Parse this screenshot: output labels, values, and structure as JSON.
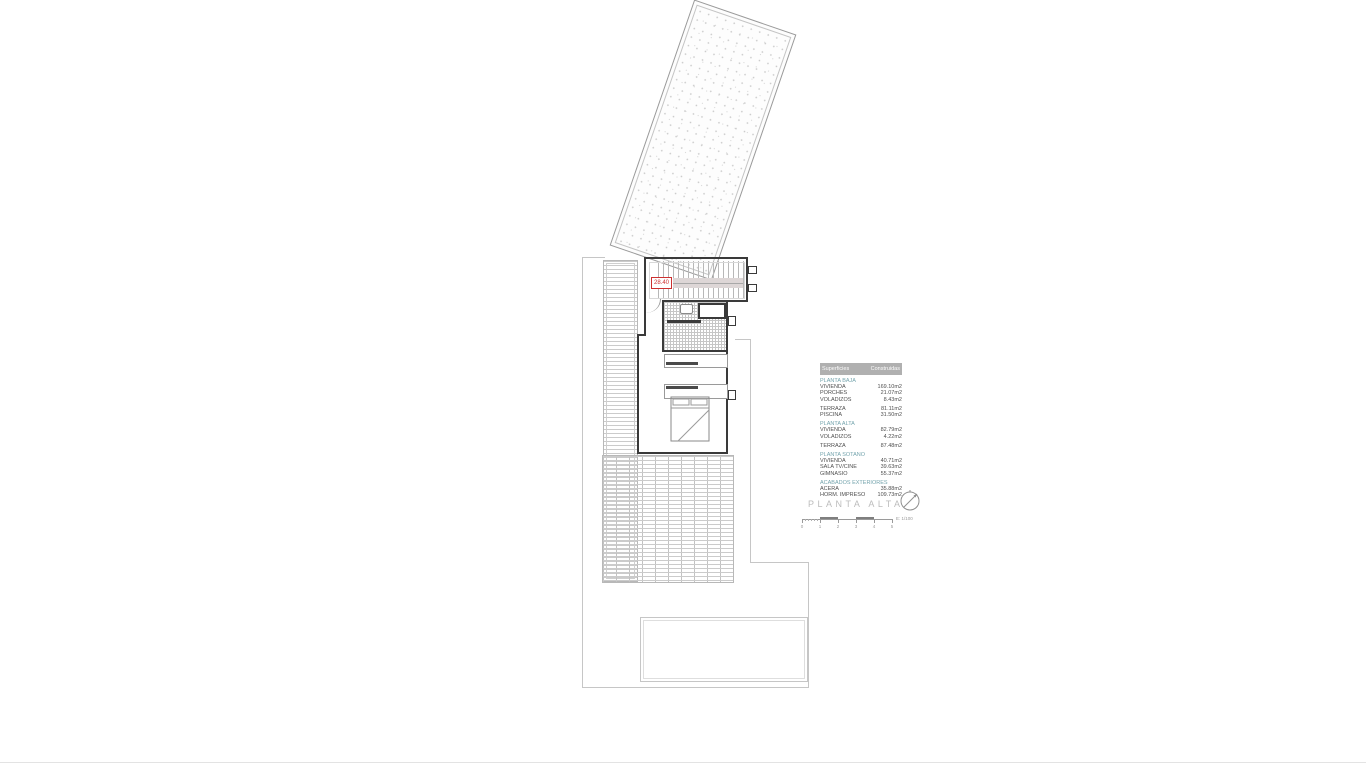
{
  "plan": {
    "title": "PLANTA ALTA",
    "level_label": "28.40",
    "scale_text": "E: 1/100",
    "scale_ticks": [
      "0",
      "1",
      "2",
      "3",
      "4",
      "5"
    ]
  },
  "table": {
    "header": {
      "col1": "Superficies",
      "col2": "Construidas"
    },
    "sections": [
      {
        "header": "PLANTA BAJA",
        "rows": [
          [
            "VIVIENDA",
            "169.10m2"
          ],
          [
            "PORCHES",
            "21.07m2"
          ],
          [
            "VOLADIZOS",
            "8.43m2"
          ]
        ]
      },
      {
        "header": "",
        "rows": [
          [
            "TERRAZA",
            "81.11m2"
          ],
          [
            "PISCINA",
            "31.50m2"
          ]
        ]
      },
      {
        "header": "PLANTA ALTA",
        "rows": [
          [
            "VIVIENDA",
            "82.79m2"
          ],
          [
            "VOLADIZOS",
            "4.22m2"
          ]
        ]
      },
      {
        "header": "",
        "rows": [
          [
            "TERRAZA",
            "87.48m2"
          ]
        ]
      },
      {
        "header": "PLANTA SOTANO",
        "rows": [
          [
            "VIVIENDA",
            "40.71m2"
          ],
          [
            "SALA TV/CINE",
            "39.63m2"
          ],
          [
            "GIMNASIO",
            "55.37m2"
          ]
        ]
      },
      {
        "header": "ACABADOS EXTERIORES",
        "rows": [
          [
            "ACERA",
            "35.88m2"
          ],
          [
            "HORM. IMPRESO",
            "109.73m2"
          ]
        ]
      }
    ]
  },
  "colors": {
    "accent_red": "#cc3030",
    "section_teal": "#74a4ad",
    "table_header_bg": "#b0b0b0",
    "wall": "#3a3a3a",
    "boundary": "#c6c6c6"
  }
}
